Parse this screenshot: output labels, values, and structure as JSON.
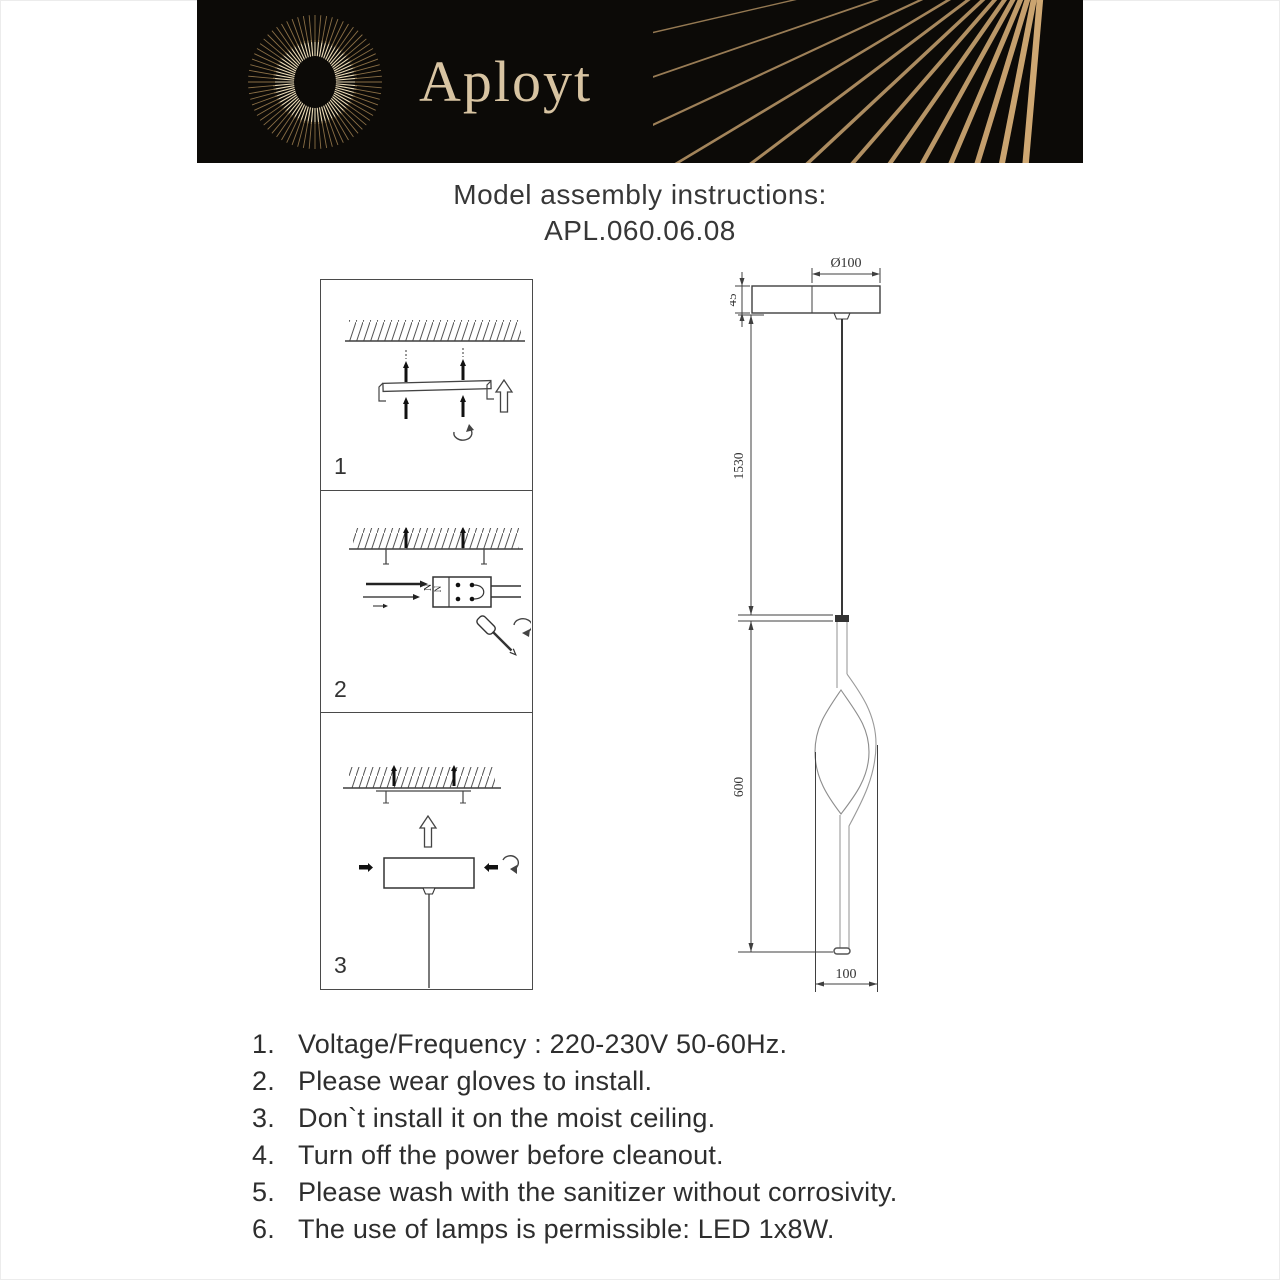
{
  "header": {
    "brand": "Aployt"
  },
  "title": {
    "line1": "Model assembly instructions:",
    "model": "APL.060.06.08"
  },
  "steps": [
    {
      "label": "1"
    },
    {
      "label": "2"
    },
    {
      "label": "3"
    }
  ],
  "step2_detail": {
    "terminal_label": "N",
    "wire_label": "N"
  },
  "drawing": {
    "dim_diameter": "Ø100",
    "dim_canopy_height": "45",
    "dim_cable_length": "1530",
    "dim_body_height": "600",
    "dim_body_width": "100"
  },
  "instructions": {
    "items": [
      {
        "num": "1.",
        "text": "Voltage/Frequency : 220-230V 50-60Hz."
      },
      {
        "num": "2.",
        "text": "Please wear gloves to install."
      },
      {
        "num": "3.",
        "text": "Don`t install it on the moist ceiling."
      },
      {
        "num": "4.",
        "text": "Turn off the power before cleanout."
      },
      {
        "num": "5.",
        "text": "Please wash with the sanitizer without corrosivity."
      },
      {
        "num": "6.",
        "text": "The use of lamps is permissible: LED 1x8W."
      }
    ]
  },
  "colors": {
    "banner_bg": "#0c0a07",
    "gold_ray": "#cfa873",
    "logo_text": "#d8c4a2",
    "line": "#4a4a4a",
    "text": "#2e2e2e"
  }
}
